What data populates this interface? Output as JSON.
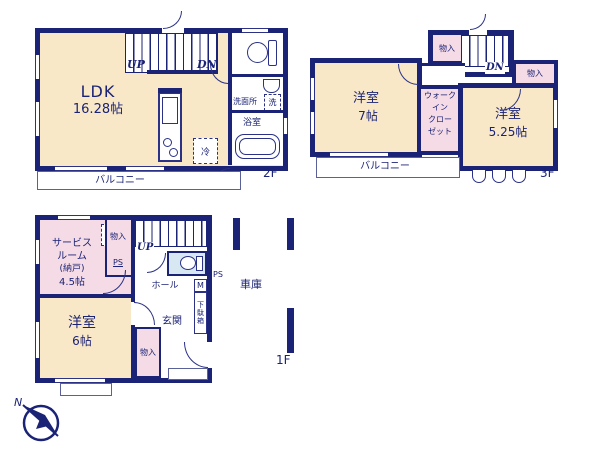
{
  "colors": {
    "wall": "#1b2376",
    "room_cream": "#f8e8c7",
    "room_pink": "#f5dbe6",
    "toilet_blue": "#d8e8f2",
    "text": "#1b2376"
  },
  "floor2": {
    "floor_label": "2F",
    "ldk_name": "LDK",
    "ldk_size": "16.28帖",
    "up": "UP",
    "dn": "DN",
    "washroom": "洗面所",
    "washer": "洗",
    "bath": "浴室",
    "fridge": "冷",
    "balcony": "バルコニー"
  },
  "floor3": {
    "floor_label": "3F",
    "dn": "DN",
    "storage_top": "物入",
    "storage_right": "物入",
    "room7_name": "洋室",
    "room7_size": "7帖",
    "wic": [
      "ウォーク",
      "イン",
      "クロー",
      "ゼット"
    ],
    "room525_name": "洋室",
    "room525_size": "5.25帖",
    "balcony": "バルコニー"
  },
  "floor1": {
    "floor_label": "1F",
    "up": "UP",
    "underfloor": [
      "床下",
      "収納"
    ],
    "service_room": [
      "サービス",
      "ルーム",
      "(納戸)",
      "4.5帖"
    ],
    "storage_top": "物入",
    "ps_top": "PS",
    "hall": "ホール",
    "meter": "M",
    "shoe_box": "下駄箱",
    "ps_right": "PS",
    "entrance": "玄関",
    "room6_name": "洋室",
    "room6_size": "6帖",
    "storage_bottom": "物入",
    "garage": "車庫"
  },
  "compass": {
    "north": "N"
  }
}
